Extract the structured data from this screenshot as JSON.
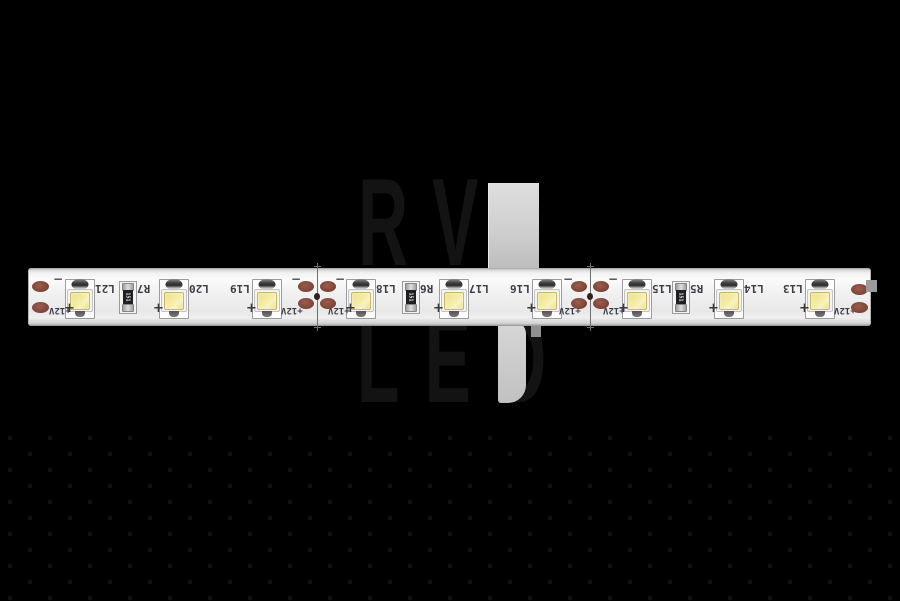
{
  "watermark": {
    "line1": "RV",
    "line2": "LED"
  },
  "strip": {
    "led_labels": [
      "L21",
      "L20",
      "L19",
      "L18",
      "L17",
      "L16",
      "L15",
      "L14",
      "L13"
    ],
    "resistor_labels": [
      "R7",
      "R6",
      "R5"
    ],
    "resistor_marking": "151",
    "voltage_label": "+12V",
    "plus_symbol": "+",
    "minus_symbol": "−"
  },
  "colors": {
    "background": "#000000",
    "strip_body": "#f2f2f2",
    "led_phosphor": "#f0e49c",
    "solder_pad_copper": "#83493c",
    "silkscreen_text": "#3d3d48",
    "watermark_highlight_gray": "#cccccc",
    "watermark_letters": "#131313"
  }
}
